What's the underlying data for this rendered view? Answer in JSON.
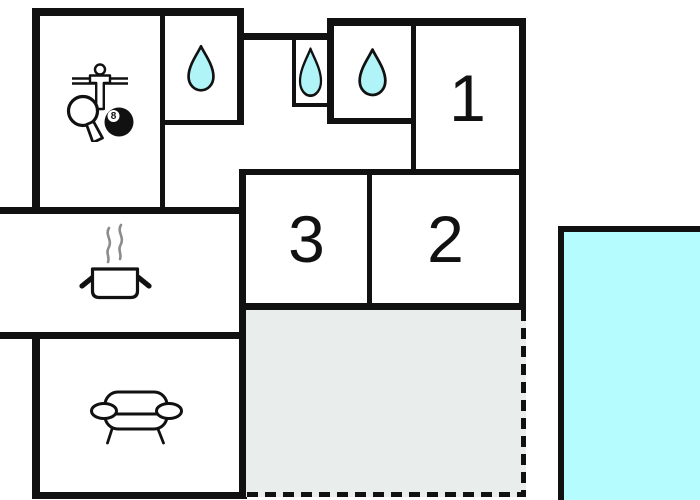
{
  "floorplan": {
    "rooms": {
      "bedroom_1": {
        "label": "1"
      },
      "bedroom_2": {
        "label": "2"
      },
      "bedroom_3": {
        "label": "3"
      },
      "games_room": {
        "icon": "game-room-icon"
      },
      "bathroom_top_left": {
        "icon": "water-drop-icon"
      },
      "shower_small": {
        "icon": "water-drop-icon"
      },
      "bathroom_top_middle": {
        "icon": "water-drop-icon"
      },
      "kitchen": {
        "icon": "cooking-pot-icon"
      },
      "living_room": {
        "icon": "sofa-icon"
      },
      "terrace": {
        "border_style": "dashed"
      },
      "pool": {
        "fill": "#b5fcff"
      }
    },
    "ball_label": "8",
    "colors": {
      "wall": "#111111",
      "water_drop": "#b0f4f8",
      "pool": "#b5fcff",
      "terrace": "#e9eeec",
      "steam": "#8c8c8c",
      "background": "#ffffff"
    }
  }
}
